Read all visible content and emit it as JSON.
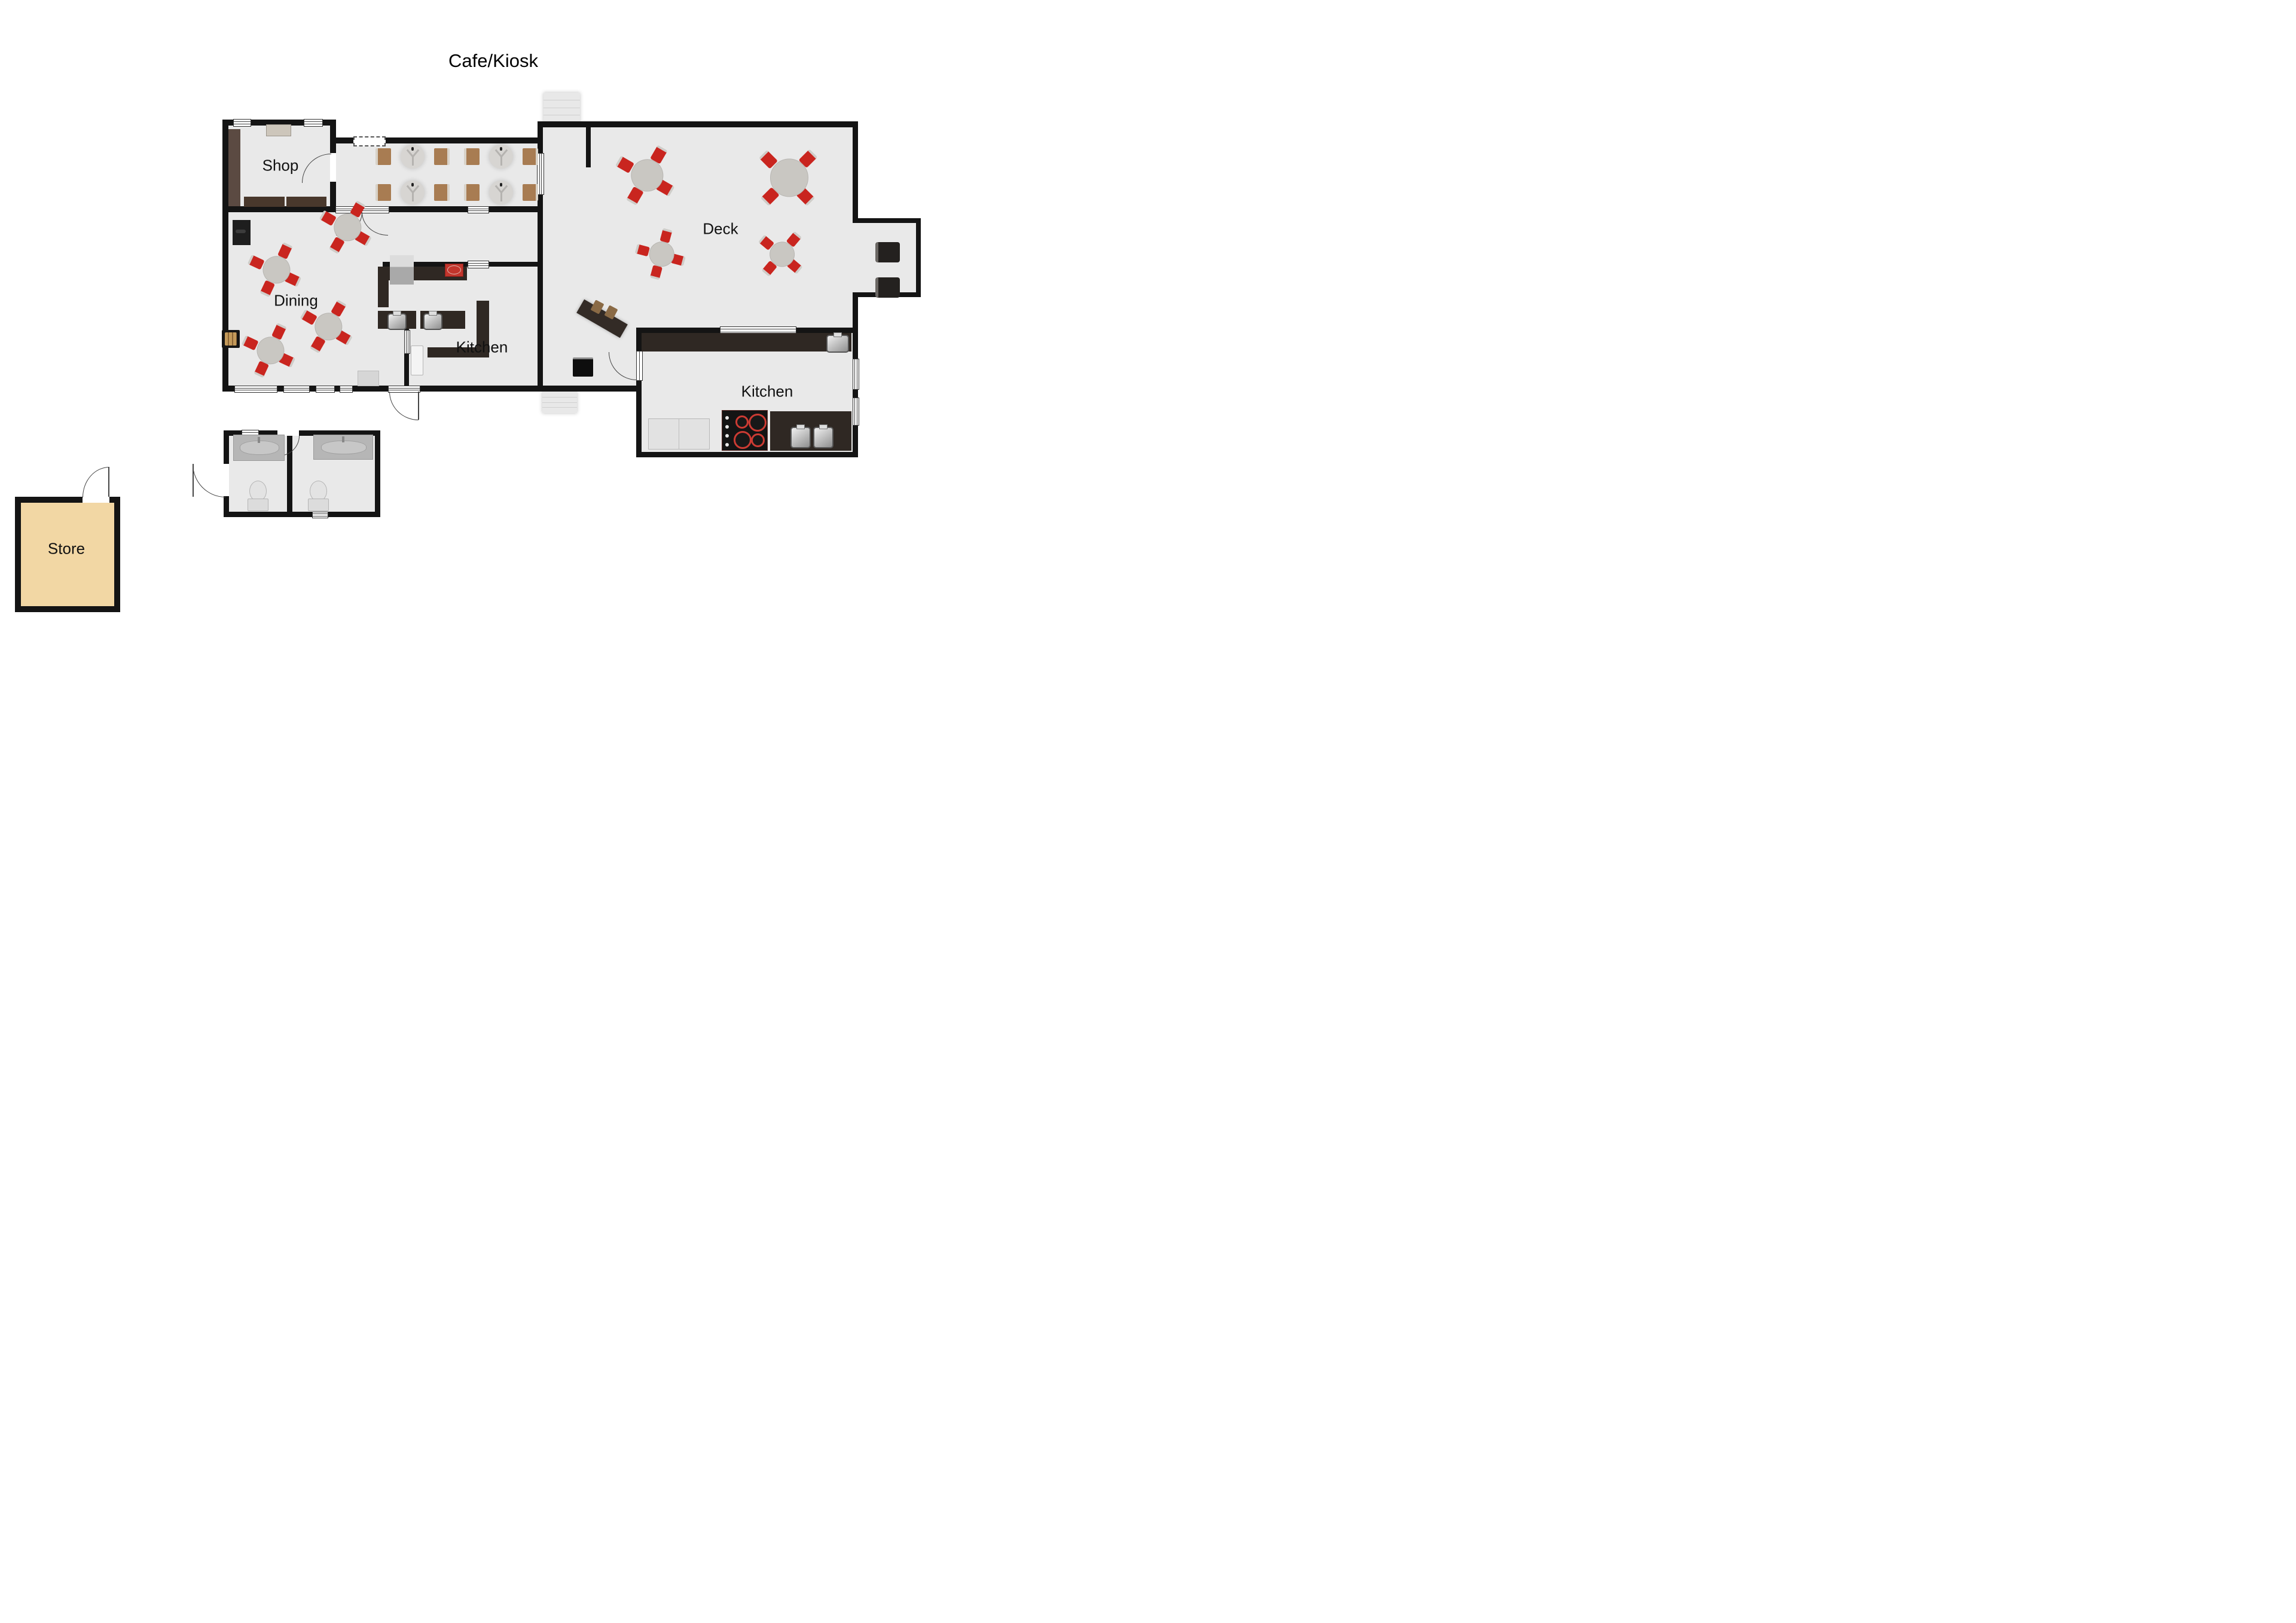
{
  "title": "Cafe/Kiosk",
  "rooms": {
    "shop": {
      "label": "Shop"
    },
    "dining": {
      "label": "Dining"
    },
    "kitchen_center": {
      "label": "Kitchen"
    },
    "kitchen_right": {
      "label": "Kitchen"
    },
    "deck": {
      "label": "Deck"
    },
    "store": {
      "label": "Store"
    }
  },
  "palette": {
    "wall": "#141414",
    "floor": "#e9e9e9",
    "store_floor": "#f2d7a4",
    "counter_dark": "#2f2823",
    "shelf_brown": "#5b4a42",
    "counter_brown": "#49382c",
    "cabinet_beige": "#cdc6bb",
    "chair_red": "#c9251f",
    "table_gray": "#c9c7c2",
    "stool_brown": "#a87c52",
    "appliance_red": "#c2352c",
    "steps_gray": "#e8e8e8"
  },
  "furniture_inventory": {
    "deck_round_tables": 4,
    "dining_round_tables": 4,
    "corridor_pedestal_tables": 4,
    "red_chairs": 32,
    "bar_stools": 8,
    "sinks": 6,
    "toilets": 2,
    "vanities": 2,
    "cooktop_burners": 4
  }
}
